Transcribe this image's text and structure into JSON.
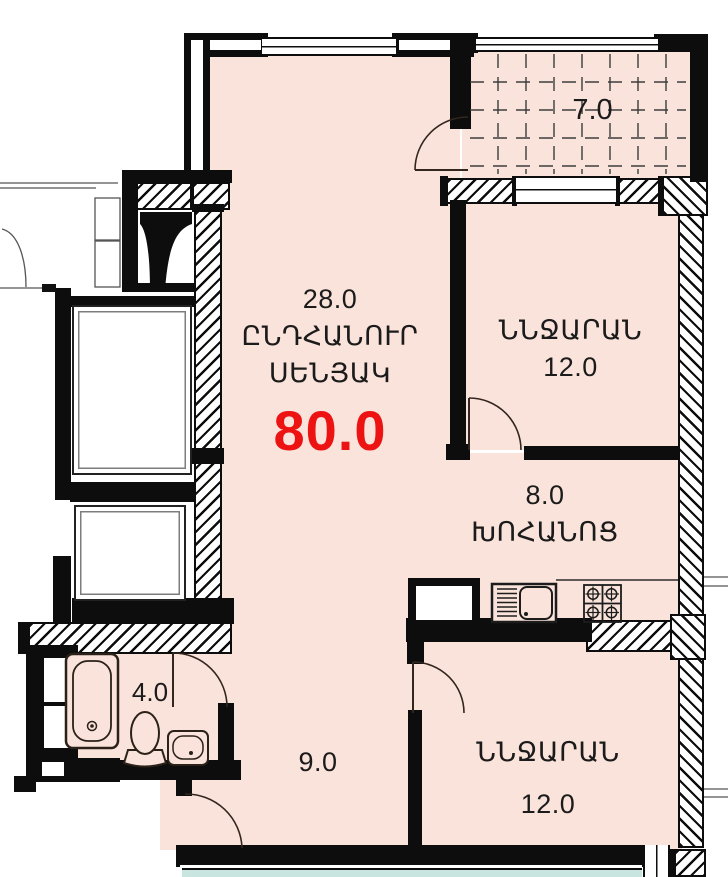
{
  "title": "apartment-floor-plan",
  "colors": {
    "room_fill": "#fae3da",
    "adjacent_fill": "#c9e5e0",
    "wall": "#0d0d0d",
    "area_total_color": "#ed1313"
  },
  "rooms": {
    "living": {
      "area": "28.0",
      "name1": "ԸՆԴՀԱՆՈՒՐ",
      "name2": "ՍԵՆՅԱԿ",
      "total": "80.0"
    },
    "bedroom_top": {
      "name": "ՆՆՋԱՐԱՆ",
      "area": "12.0"
    },
    "kitchen": {
      "area": "8.0",
      "name": "ԽՈՀԱՆՈՑ"
    },
    "bedroom_bottom": {
      "name": "ՆՆՋԱՐԱՆ",
      "area": "12.0"
    },
    "bathroom": {
      "area": "4.0"
    },
    "hallway": {
      "area": "9.0"
    },
    "balcony": {
      "area": "7.0"
    }
  }
}
